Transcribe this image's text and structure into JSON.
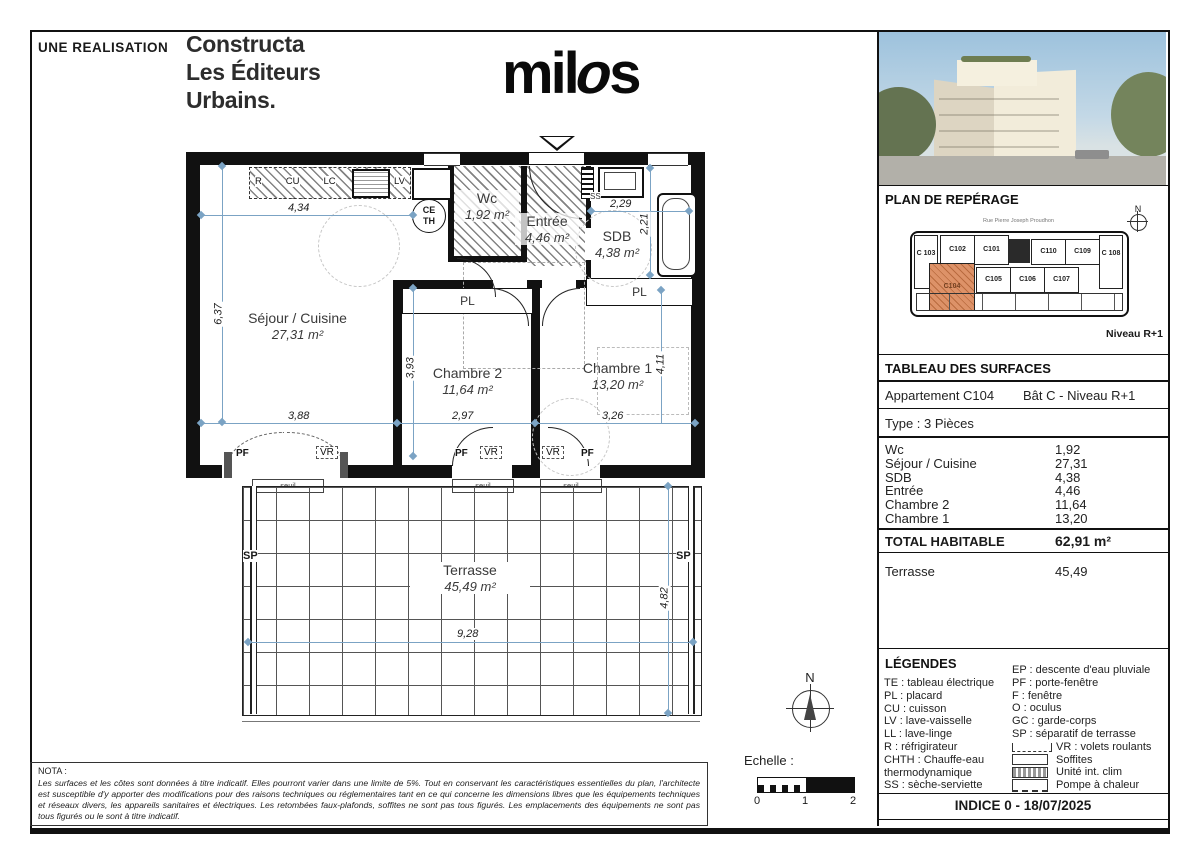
{
  "header": {
    "realisation": "UNE REALISATION",
    "developer_line1": "Constructa",
    "developer_line2": "Les Éditeurs",
    "developer_line3": "Urbains.",
    "brand_prefix": "mil",
    "brand_o": "o",
    "brand_suffix": "s"
  },
  "reperage": {
    "title": "PLAN DE REPÉRAGE",
    "street": "Rue Pierre Joseph Proudhon",
    "north": "N",
    "level": "Niveau R+1",
    "highlighted_unit": "C104",
    "highlight_color": "#dd9268",
    "units_top": [
      "C 103",
      "C102",
      "C101",
      "C110",
      "C109",
      "C 108"
    ],
    "units_bottom": [
      "C104",
      "C105",
      "C106",
      "C107"
    ]
  },
  "surfaces": {
    "title": "TABLEAU DES SURFACES",
    "apartment": "Appartement C104",
    "building": "Bât C - Niveau R+1",
    "type": "Type : 3 Pièces",
    "rows": [
      {
        "label": "Wc",
        "value": "1,92"
      },
      {
        "label": "Séjour / Cuisine",
        "value": "27,31"
      },
      {
        "label": "SDB",
        "value": "4,38"
      },
      {
        "label": "Entrée",
        "value": "4,46"
      },
      {
        "label": "Chambre 2",
        "value": "11,64"
      },
      {
        "label": "Chambre 1",
        "value": "13,20"
      }
    ],
    "total_label": "TOTAL HABITABLE",
    "total_value": "62,91 m²",
    "terrace_label": "Terrasse",
    "terrace_value": "45,49"
  },
  "legend": {
    "title": "LÉGENDES",
    "left": [
      "TE : tableau électrique",
      "PL : placard",
      "CU : cuisson",
      "LV : lave-vaisselle",
      "LL : lave-linge",
      "R : réfrigirateur",
      "CHTH : Chauffe-eau",
      "thermodynamique",
      "SS : sèche-serviette"
    ],
    "right": [
      "EP : descente d'eau pluviale",
      "PF : porte-fenêtre",
      "F : fenêtre",
      "O : oculus",
      "GC : garde-corps",
      "SP : séparatif de terrasse"
    ],
    "symbols": [
      {
        "name": "volets-roulants",
        "label": "VR : volets roulants"
      },
      {
        "name": "soffites",
        "label": "Soffites"
      },
      {
        "name": "unite-int-clim",
        "label": "Unité int. clim"
      },
      {
        "name": "pompe-a-chaleur",
        "label": "Pompe à chaleur"
      }
    ]
  },
  "indice": "INDICE 0 - 18/07/2025",
  "nota": {
    "title": "NOTA :",
    "text": "Les surfaces et les côtes sont données à titre indicatif. Elles pourront varier dans une limite de 5%. Tout en conservant les caractéristiques essentielles du plan, l'architecte est susceptible d'y apporter des modifications pour des raisons techniques ou réglementaires tant en ce qui concerne les dimensions libres que les équipements techniques et réseaux divers, les appareils sanitaires et électriques. Les retombées faux-plafonds, soffites ne sont pas tous figurés. Les emplacements des équipements ne sont pas tous figurés ou le sont à titre indicatif."
  },
  "scale": {
    "label": "Echelle :",
    "t0": "0",
    "t1": "1",
    "t2": "2"
  },
  "compass": {
    "north": "N"
  },
  "plan": {
    "rooms": {
      "sejour": {
        "name": "Séjour / Cuisine",
        "area": "27,31 m²"
      },
      "chambre2": {
        "name": "Chambre 2",
        "area": "11,64 m²"
      },
      "chambre1": {
        "name": "Chambre 1",
        "area": "13,20 m²"
      },
      "wc": {
        "name": "Wc",
        "area": "1,92 m²"
      },
      "entree": {
        "name": "Entrée",
        "area": "4,46 m²"
      },
      "sdb": {
        "name": "SDB",
        "area": "4,38 m²"
      },
      "terrasse": {
        "name": "Terrasse",
        "area": "45,49 m²"
      }
    },
    "dims": {
      "d434": "4,34",
      "d637": "6,37",
      "d388": "3,88",
      "d393": "3,93",
      "d297": "2,97",
      "d326": "3,26",
      "d411": "4,11",
      "d229": "2,29",
      "d221": "2,21",
      "d928": "9,28",
      "d482": "4,82"
    },
    "kitchen": [
      "R",
      "CU",
      "LC",
      "LL",
      "LV"
    ],
    "labels": {
      "ceth1": "CE",
      "ceth2": "TH",
      "ss": "SS",
      "pl": "PL",
      "pf": "PF",
      "vr": "VR",
      "seuil": "seuil",
      "sp": "SP"
    }
  }
}
